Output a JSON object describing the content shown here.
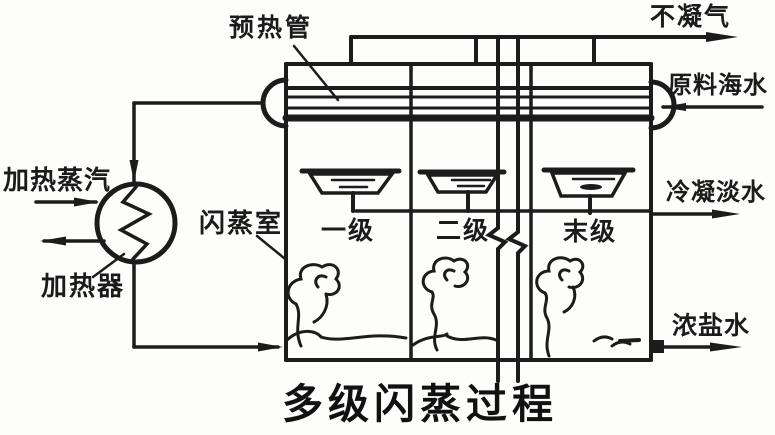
{
  "diagram": {
    "title": "多级闪蒸过程",
    "labels": {
      "preheat_tube": "预热管",
      "non_condensable_gas": "不凝气",
      "feed_seawater": "原料海水",
      "condensed_fresh_water": "冷凝淡水",
      "concentrated_brine": "浓盐水",
      "heating_steam": "加热蒸汽",
      "heater": "加热器",
      "flash_chamber": "闪蒸室",
      "stage_first": "一级",
      "stage_second": "二级",
      "stage_last": "末级"
    },
    "colors": {
      "ink": "#1c1c1c",
      "background": "#fdfdfc"
    }
  }
}
